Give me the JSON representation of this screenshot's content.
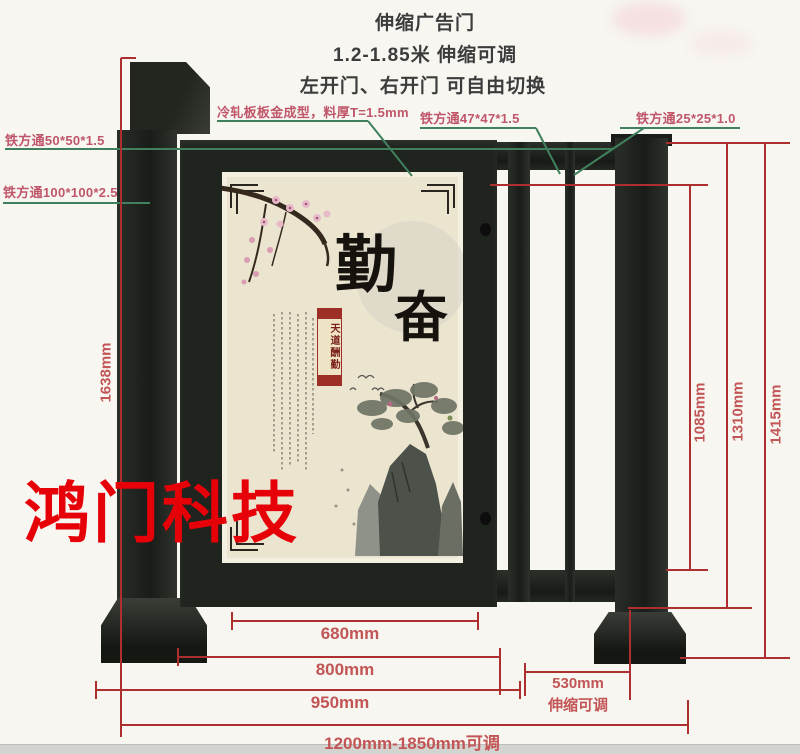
{
  "title": {
    "line1": "伸缩广告门",
    "line2": "1.2-1.85米 伸缩可调",
    "line3": "左开门、右开门 可自由切换"
  },
  "annotations": {
    "tube50": "铁方通50*50*1.5",
    "tube100": "铁方通100*100*2.5",
    "cold_rolled": "冷轧板板金成型，料厚T=1.5mm",
    "tube47": "铁方通47*47*1.5",
    "tube25": "铁方通25*25*1.0"
  },
  "dimensions": {
    "left_total_height": "1638mm",
    "right_inner_height": "1085mm",
    "right_mid_height": "1310mm",
    "right_outer_height": "1415mm",
    "panel_width": "680mm",
    "door_width": "800mm",
    "opening_width": "950mm",
    "side_width": "530mm",
    "side_note": "伸缩可调",
    "total_width": "1200mm-1850mm可调"
  },
  "watermark": "鸿门科技",
  "panel_art": {
    "char1": "勤",
    "char2": "奋",
    "seal_text": "天道酬勤"
  },
  "colors": {
    "dimension_line": "#ad2f2f",
    "dimension_text": "#c25555",
    "leader_line": "#40805c",
    "annotation_text": "#c0566a",
    "frame_metal": "#20241f",
    "panel_paper": "#ebe4cf",
    "watermark_red": "#e60008"
  }
}
